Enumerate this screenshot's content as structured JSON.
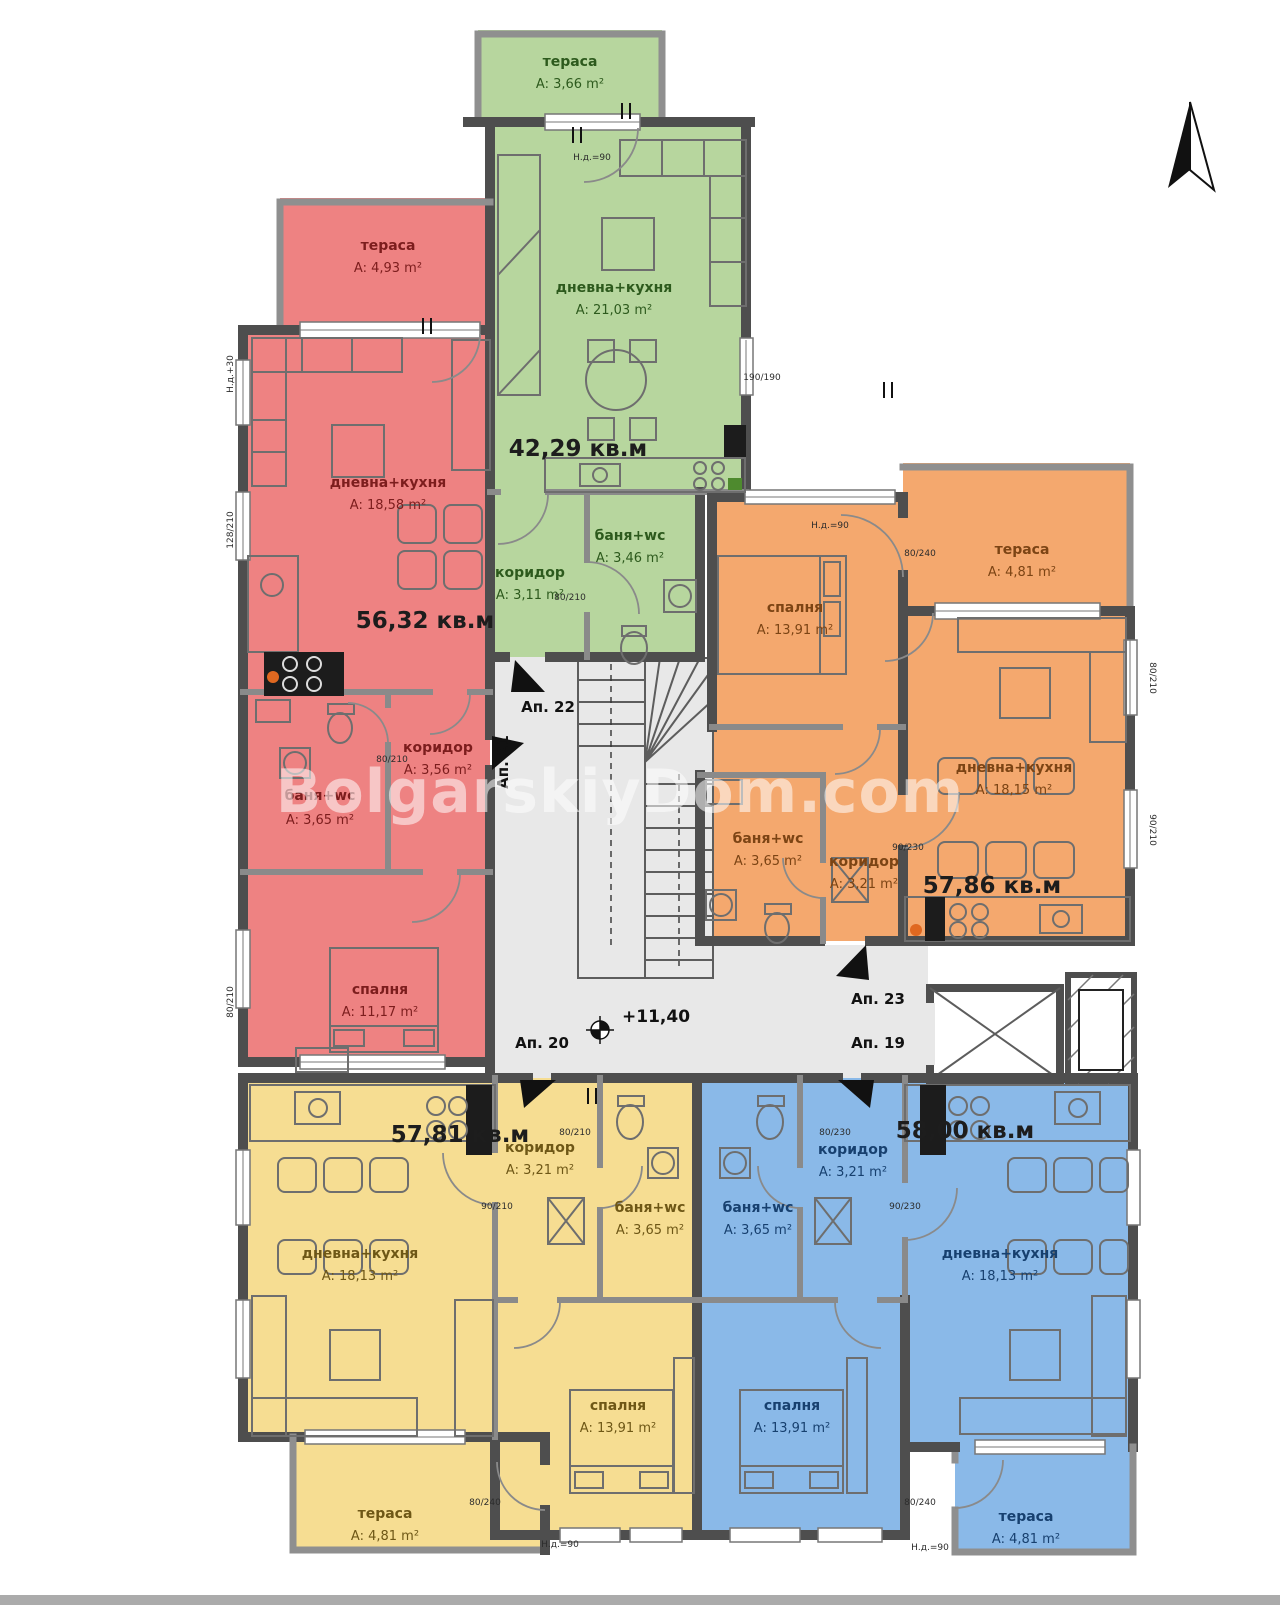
{
  "watermark": "BolgarskiyDom.com",
  "level_mark": "+11,40",
  "colors": {
    "green": "#b7d69e",
    "red": "#ee8282",
    "orange": "#f4a86e",
    "yellow": "#f6dd92",
    "blue": "#8ab9e8",
    "core": "#e8e8e8",
    "wall": "#4e4e4e"
  },
  "apartments": {
    "green": {
      "number": "Ап. 22",
      "total": "42,29 кв.м",
      "rooms": {
        "terrace": {
          "name": "тераса",
          "area": "A: 3,66 m²"
        },
        "living": {
          "name": "дневна+кухня",
          "area": "A: 21,03 m²"
        },
        "corridor": {
          "name": "коридор",
          "area": "A: 3,11 m²"
        },
        "bath": {
          "name": "баня+wc",
          "area": "A: 3,46 m²"
        }
      }
    },
    "red": {
      "number": "Ап. 21",
      "total": "56,32 кв.м",
      "rooms": {
        "terrace": {
          "name": "тераса",
          "area": "A: 4,93 m²"
        },
        "living": {
          "name": "дневна+кухня",
          "area": "A: 18,58 m²"
        },
        "bath": {
          "name": "баня+wc",
          "area": "A: 3,65 m²"
        },
        "corridor": {
          "name": "коридор",
          "area": "A: 3,56 m²"
        },
        "bedroom": {
          "name": "спалня",
          "area": "A: 11,17 m²"
        }
      }
    },
    "orange": {
      "number": "Ап. 23",
      "total": "57,86 кв.м",
      "rooms": {
        "bedroom": {
          "name": "спалня",
          "area": "A: 13,91 m²"
        },
        "terrace": {
          "name": "тераса",
          "area": "A: 4,81 m²"
        },
        "living": {
          "name": "дневна+кухня",
          "area": "A: 18,15 m²"
        },
        "bath": {
          "name": "баня+wc",
          "area": "A: 3,65 m²"
        },
        "corridor": {
          "name": "коридор",
          "area": "A: 3,21 m²"
        }
      }
    },
    "yellow": {
      "number": "Ап. 20",
      "total": "57,81 кв.м",
      "rooms": {
        "living": {
          "name": "дневна+кухня",
          "area": "A: 18,13 m²"
        },
        "corridor": {
          "name": "коридор",
          "area": "A: 3,21 m²"
        },
        "bath": {
          "name": "баня+wc",
          "area": "A: 3,65 m²"
        },
        "bedroom": {
          "name": "спалня",
          "area": "A: 13,91 m²"
        },
        "terrace": {
          "name": "тераса",
          "area": "A: 4,81 m²"
        }
      }
    },
    "blue": {
      "number": "Ап. 19",
      "total": "58,00 кв.м",
      "rooms": {
        "living": {
          "name": "дневна+кухня",
          "area": "A: 18,13 m²"
        },
        "corridor": {
          "name": "коридор",
          "area": "A: 3,21 m²"
        },
        "bath": {
          "name": "баня+wc",
          "area": "A: 3,65 m²"
        },
        "bedroom": {
          "name": "спалня",
          "area": "A: 13,91 m²"
        },
        "terrace": {
          "name": "тераса",
          "area": "A: 4,81 m²"
        }
      }
    }
  },
  "dims": [
    "80/210",
    "90/210",
    "80/240",
    "90/230",
    "80/230",
    "128/210",
    "Н.д.=90",
    "Н.д.+30",
    "190/190"
  ]
}
